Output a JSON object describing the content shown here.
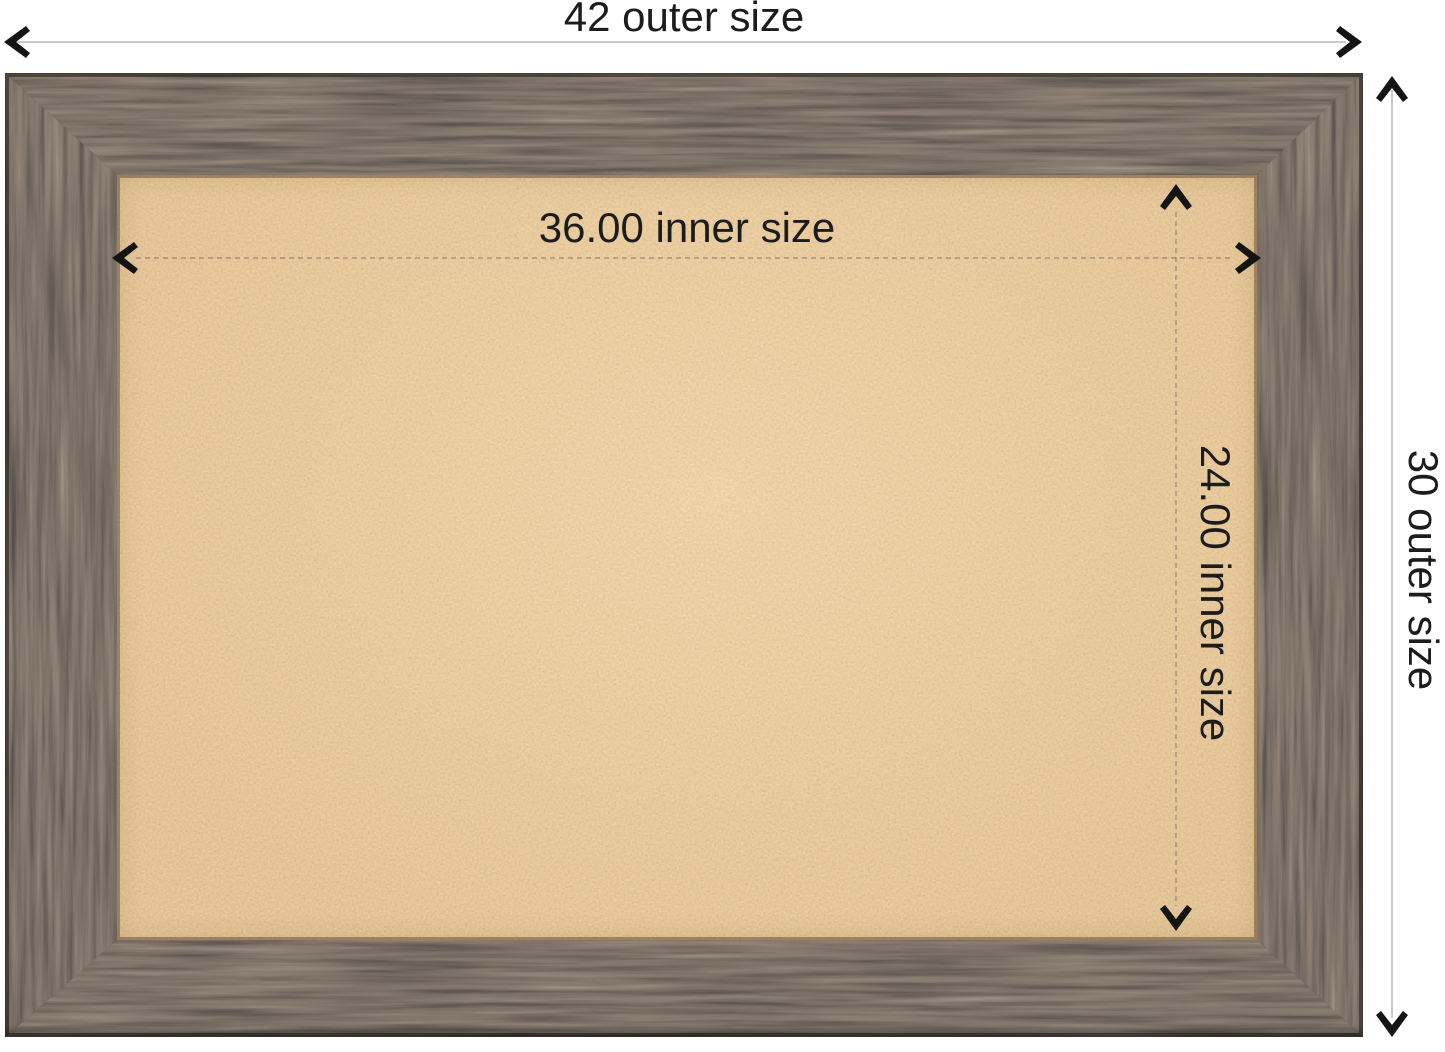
{
  "annotations": {
    "outer_width_label": "42 outer size",
    "outer_height_label": "30 outer size",
    "inner_width_label": "36.00 inner size",
    "inner_height_label": "24.00 inner size"
  },
  "board": {
    "frame_material": "rustic dark barnwood frame",
    "surface_material": "natural cork"
  },
  "colors": {
    "background": "#ffffff",
    "annotation_text": "#1c1c1c",
    "arrow": "#141414",
    "outer_dim_line": "#c9c9c9",
    "inner_dim_line": "#6f675c",
    "frame_wood_base": "#443a31",
    "frame_wood_light": "#70604f",
    "frame_wood_dark": "#241f1a",
    "cork_base": "#d5a267",
    "cork_speckle_dark": "#b5803f",
    "cork_speckle_light": "#ecca96"
  }
}
